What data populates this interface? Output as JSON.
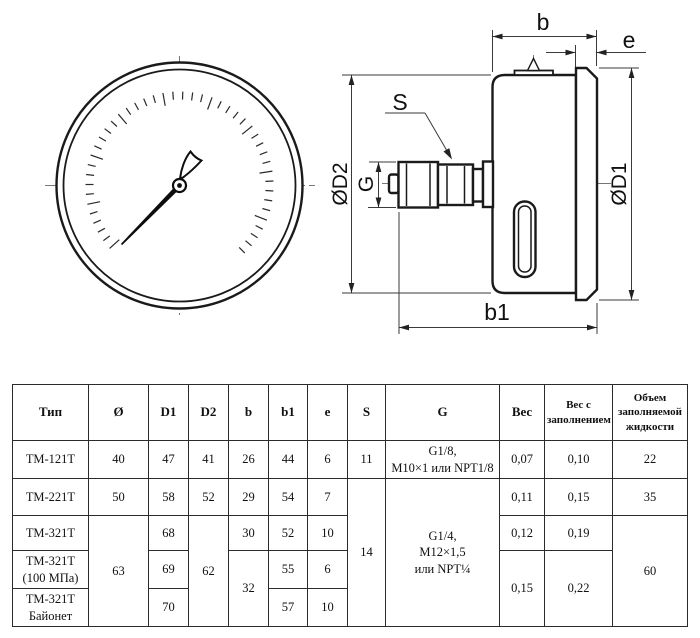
{
  "drawing": {
    "labels": {
      "b": "b",
      "e": "e",
      "s": "S",
      "g": "G",
      "d1": "ØD1",
      "d2": "ØD2",
      "b1": "b1"
    }
  },
  "table": {
    "headers": [
      "Тип",
      "Ø",
      "D1",
      "D2",
      "b",
      "b1",
      "e",
      "S",
      "G",
      "Вес",
      "Вес с\nзаполнением",
      "Объем\nзаполняемой\nжидкости"
    ],
    "rows": [
      [
        "ТМ-121Т",
        "40",
        "47",
        "41",
        "26",
        "44",
        "6",
        "11",
        "G1/8,\nM10×1 или NPT1/8",
        "0,07",
        "0,10",
        "22"
      ],
      [
        "ТМ-221Т",
        "50",
        "58",
        "52",
        "29",
        "54",
        "7",
        "14",
        "G1/4,\nM12×1,5\nили NPT¼",
        "0,11",
        "0,15",
        "35"
      ],
      [
        "ТМ-321Т",
        "63",
        "68",
        "62",
        "30",
        "52",
        "10",
        "0,12",
        "0,19",
        "60"
      ],
      [
        "ТМ-321Т\n(100 МПа)",
        "69",
        "32",
        "55",
        "6",
        "0,15",
        "0,22"
      ],
      [
        "ТМ-321Т\nБайонет",
        "70",
        "57",
        "10"
      ]
    ]
  }
}
